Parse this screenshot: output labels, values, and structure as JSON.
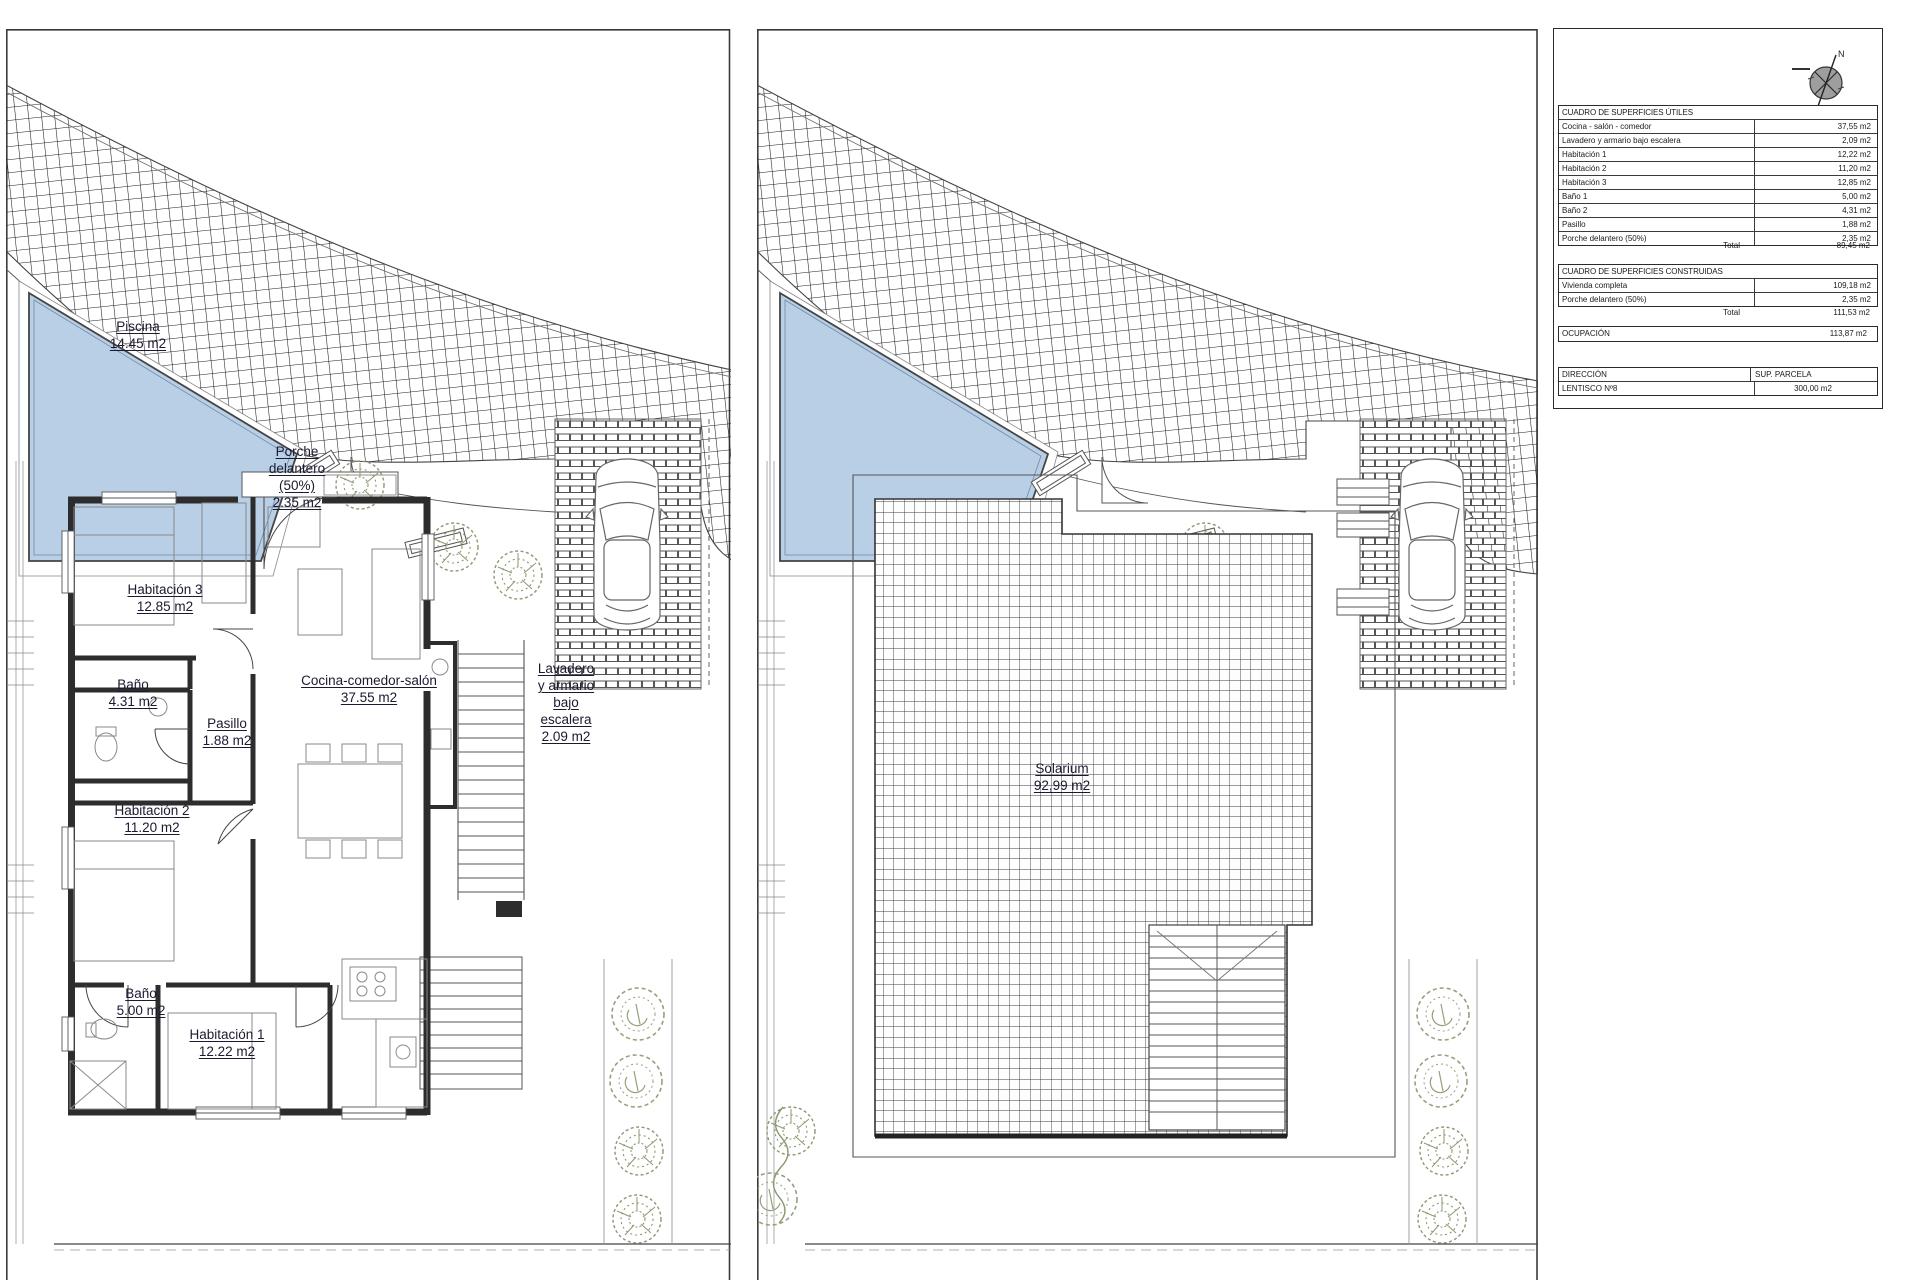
{
  "plans": {
    "ground": {
      "labels": {
        "piscina": [
          "Piscina",
          "14.45 m2"
        ],
        "porche": [
          "Porche",
          "delantero",
          "(50%)",
          "2.35 m2"
        ],
        "hab3": [
          "Habitación 3",
          "12.85 m2"
        ],
        "bano2": [
          "Baño",
          "4.31 m2"
        ],
        "pasillo": [
          "Pasillo",
          "1.88 m2"
        ],
        "cocina": [
          "Cocina-comedor-salón",
          "37.55 m2"
        ],
        "lavadero": [
          "Lavadero",
          "y armario",
          "bajo",
          "escalera",
          "2.09 m2"
        ],
        "hab2": [
          "Habitación 2",
          "11.20 m2"
        ],
        "bano1": [
          "Baño",
          "5.00 m2"
        ],
        "hab1": [
          "Habitación 1",
          "12.22 m2"
        ]
      }
    },
    "roof": {
      "labels": {
        "solarium": [
          "Solarium",
          "92,99 m2"
        ]
      }
    }
  },
  "panel": {
    "compass_letter": "N",
    "useful": {
      "title": "CUADRO DE SUPERFICIES ÚTILES",
      "rows": [
        {
          "label": "Cocina - salón - comedor",
          "value": "37,55 m2"
        },
        {
          "label": "Lavadero y armario bajo escalera",
          "value": "2,09 m2"
        },
        {
          "label": "Habitación 1",
          "value": "12,22 m2"
        },
        {
          "label": "Habitación 2",
          "value": "11,20 m2"
        },
        {
          "label": "Habitación 3",
          "value": "12,85 m2"
        },
        {
          "label": "Baño 1",
          "value": "5,00 m2"
        },
        {
          "label": "Baño 2",
          "value": "4,31 m2"
        },
        {
          "label": "Pasillo",
          "value": "1,88 m2"
        },
        {
          "label": "Porche delantero (50%)",
          "value": "2,35 m2"
        }
      ],
      "total_label": "Total",
      "total_value": "89,45 m2"
    },
    "built": {
      "title": "CUADRO DE SUPERFICIES CONSTRUIDAS",
      "rows": [
        {
          "label": "Vivienda completa",
          "value": "109,18 m2"
        },
        {
          "label": "Porche delantero (50%)",
          "value": "2,35 m2"
        }
      ],
      "total_label": "Total",
      "total_value": "111,53 m2"
    },
    "ocupacion": {
      "label": "OCUPACIÓN",
      "value": "113,87 m2"
    },
    "direccion": {
      "header_label": "DIRECCIÓN",
      "header_value": "SUP. PARCELA",
      "row_label": "LENTISCO Nº8",
      "row_value": "300,00 m2"
    }
  },
  "colors": {
    "pool": "#b9cfe6",
    "wall": "#2d2d2d",
    "tree": "#8a9a71",
    "label_ink": "#1a1a30"
  }
}
